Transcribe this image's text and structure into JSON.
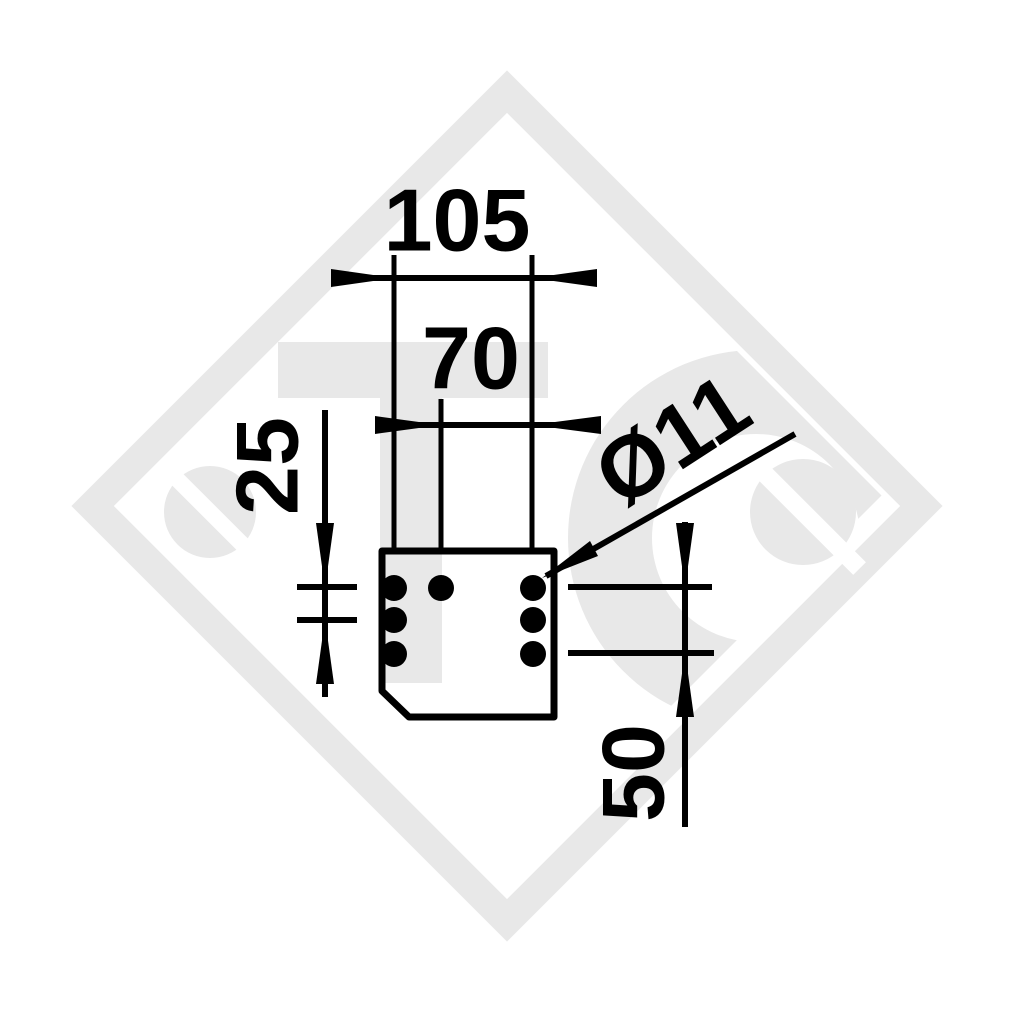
{
  "drawing": {
    "kind": "technical dimension drawing of drilled mounting plate",
    "ink_color": "#000000",
    "background_color": "#ffffff",
    "labels": {
      "outer_width": "105",
      "inner_width": "70",
      "left_row_spacing": "25",
      "right_row_spacing": "50",
      "hole_diameter": "Ø11"
    },
    "plate": {
      "hole_count": 7,
      "hole_rows": 3,
      "chamfer": "bottom-left"
    }
  },
  "watermark": {
    "color": "#e8e8e8",
    "letters": [
      "e",
      "T",
      "C",
      "e"
    ],
    "shape": "diamond-border"
  }
}
